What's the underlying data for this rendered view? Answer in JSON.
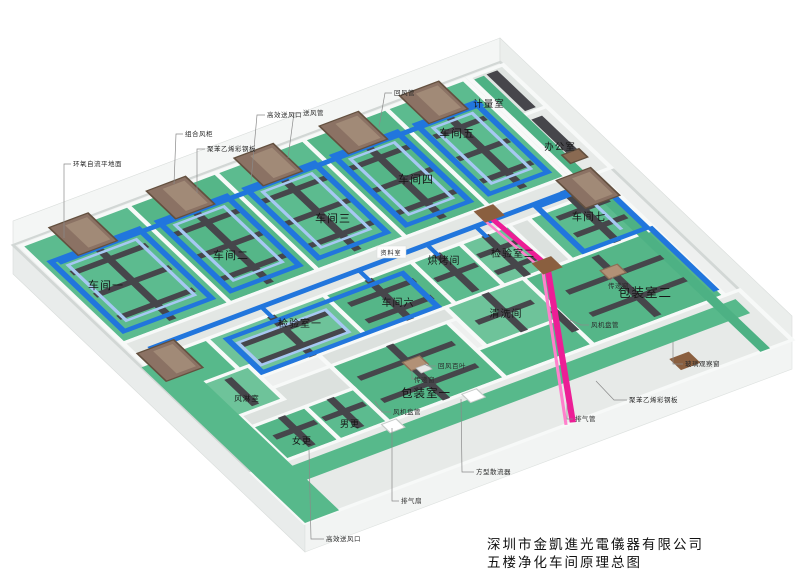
{
  "title": {
    "company": "深圳市金凱進光電儀器有限公司",
    "drawing": "五楼净化车间原理总图"
  },
  "rooms": {
    "workshop1": "车间一",
    "workshop2": "车间二",
    "workshop3": "车间三",
    "workshop4": "车间四",
    "workshop5": "车间五",
    "workshop6": "车间六",
    "workshop7": "车间七",
    "inspection1": "检验室一",
    "inspection2": "检验室二",
    "packing1": "包装室一",
    "packing2": "包装室二",
    "cleaning": "清洗间",
    "baking": "烘烤间",
    "metering": "计量室",
    "office": "办公室",
    "data_room": "资料室",
    "air_shower": "风淋室",
    "male_changing": "男更",
    "female_changing": "女更"
  },
  "callouts": {
    "epoxy_floor": "环氧自流平地面",
    "combined_ahu": "组合风柜",
    "panel_left": "聚苯乙烯彩钢板",
    "hepa_outlet_top": "高效送风口",
    "supply_duct": "送风管",
    "return_duct": "回风管",
    "return_louver": "回风百叶",
    "transfer_window_1": "传递窗",
    "transfer_window_2": "传递窗",
    "fan_coil_1": "风机盘管",
    "fan_coil_2": "风机盘管",
    "glass_window": "玻璃观察窗",
    "panel_right": "聚苯乙烯彩钢板",
    "exhaust_duct": "排气管",
    "exhaust_fan": "排气扇",
    "square_diffuser": "方型散流器",
    "hepa_outlet_bottom": "高效送风口"
  },
  "colors": {
    "floor_green": "#55b688",
    "floor_green_light": "#6ec39a",
    "walkway_green": "#57b98b",
    "duct_blue": "#2176dd",
    "duct_light_blue": "#a6c8f2",
    "duct_dark": "#46464b",
    "ahu_brown": "#8b7264",
    "exhaust_pink": "#ec1e96",
    "wall_white": "#f4f6f5",
    "open_floor": "#e7eae8"
  }
}
